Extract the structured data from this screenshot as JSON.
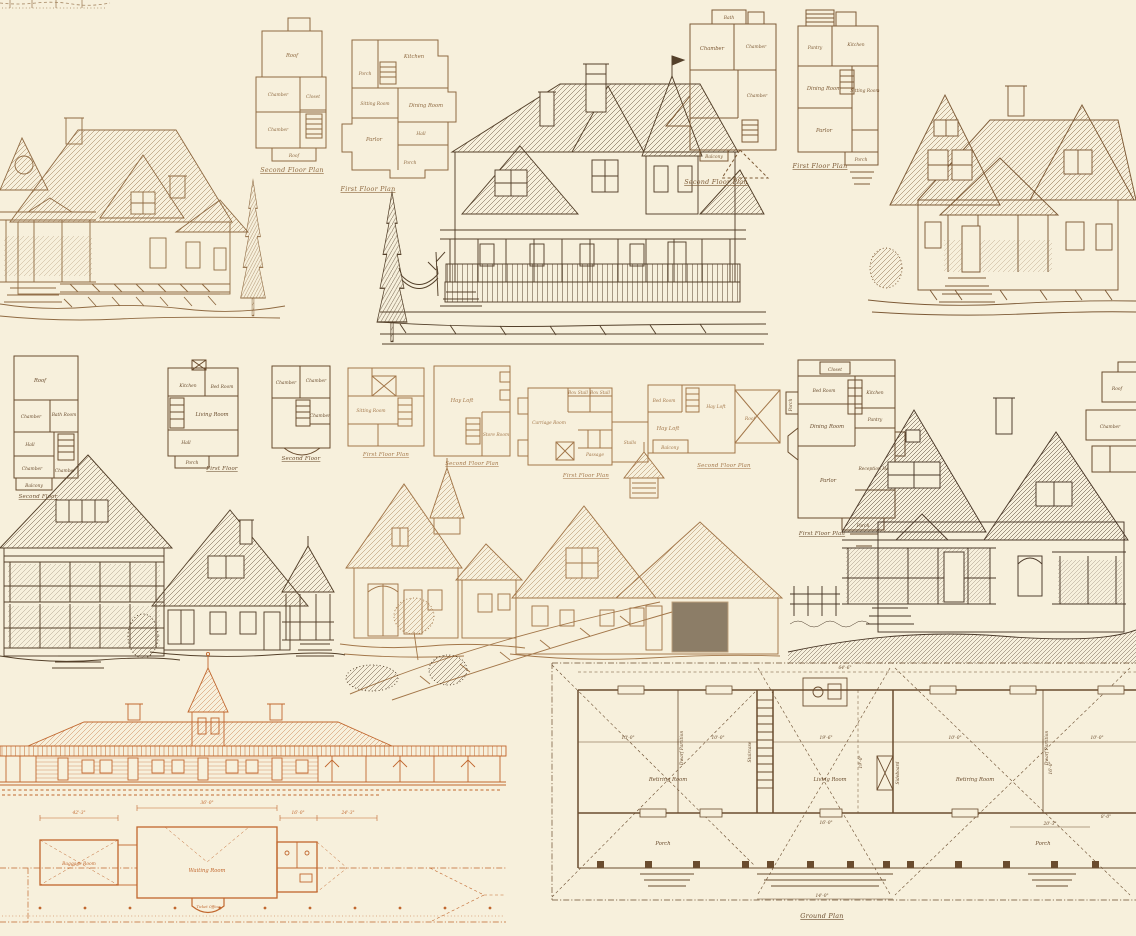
{
  "art": {
    "background": "#f7f0dc",
    "inks": {
      "tan": "#8f6a42",
      "sepia": "#54402a",
      "brown": "#7d5a36",
      "gold": "#a3774a",
      "orange": "#c1672e",
      "umber": "#6a4c2e",
      "dark": "#4a3828"
    }
  },
  "plans": {
    "tl2": {
      "caption": "Second Floor Plan",
      "rooms": {
        "roof_top": "Roof",
        "chamber1": "Chamber",
        "closet": "Closet",
        "chamber2": "Chamber",
        "roof_bottom": "Roof"
      }
    },
    "tl1": {
      "caption": "First Floor Plan",
      "rooms": {
        "porch_top": "Porch",
        "kitchen": "Kitchen",
        "sitting": "Sitting Room",
        "dining": "Dining Room",
        "parlor": "Parlor",
        "hall": "Hall",
        "porch_bottom": "Porch"
      }
    },
    "tr2": {
      "caption": "Second Floor Plan",
      "rooms": {
        "bath": "Bath",
        "chamber1": "Chamber",
        "chamber2": "Chamber",
        "chamber3": "Chamber",
        "balcony": "Balcony"
      }
    },
    "tr1": {
      "caption": "First Floor Plan",
      "rooms": {
        "pantry": "Pantry",
        "kitchen": "Kitchen",
        "dining": "Dining Room",
        "sitting": "Sitting Room",
        "parlor": "Parlor",
        "porch": "Porch"
      }
    },
    "mla": {
      "caption": "Second Floor",
      "rooms": {
        "roof": "Roof",
        "chamber1": "Chamber",
        "bath": "Bath Room",
        "hall": "Hall",
        "chamber2": "Chamber",
        "chamber3": "Chamber",
        "balcony": "Balcony"
      }
    },
    "mlb": {
      "caption": "First Floor",
      "rooms": {
        "kitchen": "Kitchen",
        "bedroom": "Bed Room",
        "living": "Living Room",
        "hall": "Hall",
        "porch": "Porch"
      }
    },
    "mlc": {
      "caption": "Second Floor",
      "rooms": {
        "chamber1": "Chamber",
        "chamber2": "Chamber",
        "chamber3": "Chamber"
      }
    },
    "sta": {
      "caption": "First Floor Plan",
      "rooms": {
        "sitting": "Sitting Room"
      }
    },
    "stb": {
      "caption": "Second Floor Plan",
      "rooms": {
        "hayloft": "Hay Loft",
        "store": "Store Room"
      }
    },
    "stc": {
      "caption": "First Floor Plan",
      "rooms": {
        "carriage": "Carriage Room",
        "box1": "Box Stall",
        "box2": "Box Stall",
        "stalls": "Stalls",
        "passage": "Passage"
      }
    },
    "std": {
      "caption": "Second Floor Plan",
      "rooms": {
        "bedroom": "Bed Room",
        "hayloft": "Hay Loft",
        "hayloft2": "Hay Loft",
        "balcony": "Balcony",
        "roof": "Roof"
      }
    },
    "mr": {
      "caption": "First Floor Plan",
      "rooms": {
        "closet": "Closet",
        "bedroom": "Bed Room",
        "kitchen": "Kitchen",
        "porch_side": "Porch",
        "dining": "Dining Room",
        "pantry": "Pantry",
        "parlor": "Parlor",
        "hall": "Reception Hall",
        "porch": "Porch"
      }
    },
    "edge": {
      "rooms": {
        "roof": "Roof",
        "chamber": "Chamber"
      }
    }
  },
  "station": {
    "rooms": {
      "baggage": "Baggage Room",
      "waiting": "Waiting Room",
      "ticket": "Ticket Office"
    },
    "dims": {
      "d1": "42'-3\"",
      "d2": "36'-0\"",
      "d3": "16'-0\"",
      "d4": "24'-3\""
    }
  },
  "ground": {
    "caption": "Ground Plan",
    "rooms": {
      "retiring_l": "Retiring Room",
      "living": "Living Room",
      "retiring_r": "Retiring Room",
      "porch_l": "Porch",
      "porch_r": "Porch"
    },
    "notes": {
      "dwarf_l": "Dwarf Partition",
      "dwarf_r": "Dwarf Partition",
      "stair": "Staircase",
      "sideboard": "Sideboard"
    },
    "dims": {
      "top": "64'-6\"",
      "left_a": "10'-0\"",
      "left_b": "10'-0\"",
      "center_w": "19'-6\"",
      "center_h": "19'-0\"",
      "right_a": "10'-0\"",
      "right_b": "10'-0\"",
      "right_h": "16'-0\"",
      "porch_c": "16'-0\"",
      "bottom": "14'-0\"",
      "porch_r": "20'-3\"",
      "porch_r2": "8'-0\""
    }
  }
}
